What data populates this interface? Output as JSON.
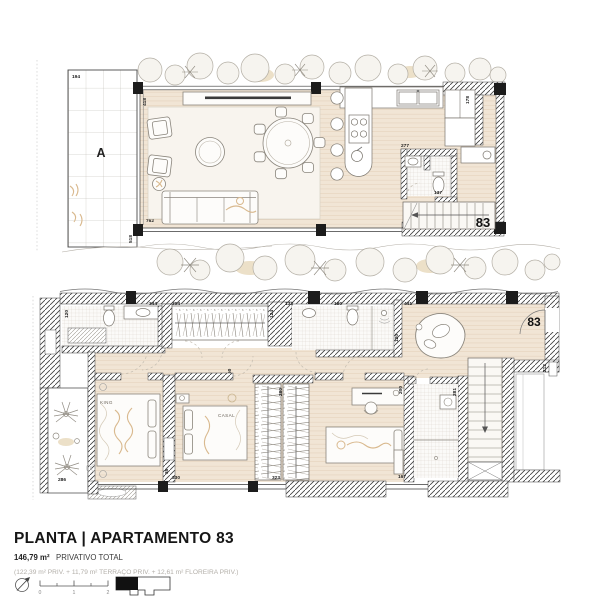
{
  "upper_plan": {
    "terrace_label": "A",
    "unit_number": "83",
    "dims": {
      "d194": "194",
      "d418": "418",
      "d518": "518",
      "d762": "762",
      "d178": "178",
      "d277": "277",
      "d137": "137"
    }
  },
  "lower_plan": {
    "unit_number": "83",
    "king_label": "KING",
    "casal_label": "CASAL",
    "dims": {
      "d120a": "120",
      "d344": "344",
      "d304": "304",
      "d124": "124",
      "d133": "133",
      "d180": "180",
      "d120b": "120",
      "d441": "441",
      "d212": "212",
      "d280": "280",
      "d323": "323",
      "d286": "286",
      "d330": "330",
      "d35": "35",
      "d60": "60",
      "d200": "200",
      "d281": "281",
      "d167": "167"
    }
  },
  "footer": {
    "title": "PLANTA | APARTAMENTO 83",
    "area_total_value": "146,79 m²",
    "area_total_label": "PRIVATIVO TOTAL",
    "area_breakdown": "(122,39 m² PRIV. + 11,79 m² TERRAÇO PRIV. + 12,61 m² FLOREIRA PRIV.)",
    "scale_ticks": [
      "0",
      "1",
      "2"
    ]
  }
}
